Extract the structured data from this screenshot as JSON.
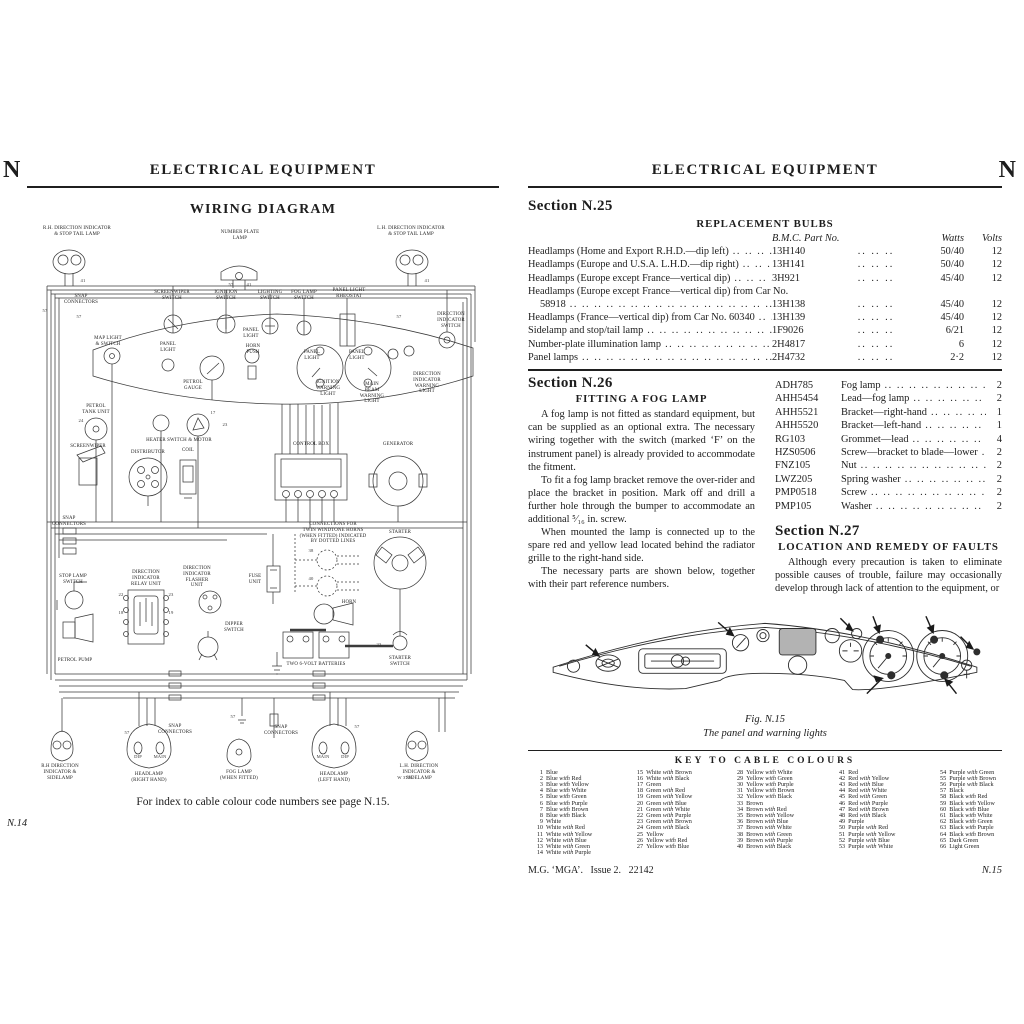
{
  "left_page": {
    "corner_letter": "N",
    "header": "ELECTRICAL EQUIPMENT",
    "title": "WIRING DIAGRAM",
    "footer_note": "For index to cable colour code numbers see page N.15.",
    "page_number": "N.14",
    "diagram_labels": [
      {
        "t": "R.H. DIRECTION INDICATOR\n& STOP TAIL LAMP",
        "x": 50,
        "y": 4,
        "w": 70
      },
      {
        "t": "NUMBER PLATE\nLAMP",
        "x": 213,
        "y": 8
      },
      {
        "t": "L.H. DIRECTION INDICATOR\n& STOP TAIL LAMP",
        "x": 384,
        "y": 4,
        "w": 70
      },
      {
        "t": "SNAP\nCONNECTORS",
        "x": 54,
        "y": 72
      },
      {
        "t": "SCREENWIPER\nSWITCH",
        "x": 145,
        "y": 68
      },
      {
        "t": "IGNITION\nSWITCH",
        "x": 199,
        "y": 68
      },
      {
        "t": "LIGHTING\nSWITCH",
        "x": 243,
        "y": 68
      },
      {
        "t": "FOG LAMP\nSWITCH",
        "x": 277,
        "y": 68
      },
      {
        "t": "PANEL LIGHT\nRHEOSTAT",
        "x": 322,
        "y": 66
      },
      {
        "t": "DIRECTION\nINDICATOR\nSWITCH",
        "x": 424,
        "y": 90
      },
      {
        "t": "MAP LIGHT\n& SWITCH",
        "x": 81,
        "y": 114
      },
      {
        "t": "PANEL\nLIGHT",
        "x": 141,
        "y": 120
      },
      {
        "t": "PANEL\nLIGHT",
        "x": 224,
        "y": 106
      },
      {
        "t": "HORN\nPUSH",
        "x": 226,
        "y": 122
      },
      {
        "t": "PETROL\nGAUGE",
        "x": 166,
        "y": 158
      },
      {
        "t": "PANEL\nLIGHT",
        "x": 285,
        "y": 128
      },
      {
        "t": "PANEL\nLIGHT",
        "x": 330,
        "y": 128
      },
      {
        "t": "IGNITION\nWARNING\nLIGHT",
        "x": 301,
        "y": 158
      },
      {
        "t": "MAIN\nBEAM\nWARNING\nLIGHT",
        "x": 345,
        "y": 160
      },
      {
        "t": "DIRECTION\nINDICATOR\nWARNING\nLIGHT",
        "x": 400,
        "y": 150
      },
      {
        "t": "PETROL\nTANK UNIT",
        "x": 69,
        "y": 182
      },
      {
        "t": "SCREENWIPER",
        "x": 61,
        "y": 222
      },
      {
        "t": "DISTRIBUTOR",
        "x": 121,
        "y": 228
      },
      {
        "t": "COIL",
        "x": 161,
        "y": 226
      },
      {
        "t": "HEATER SWITCH & MOTOR",
        "x": 152,
        "y": 216,
        "w": 90
      },
      {
        "t": "CONTROL BOX",
        "x": 284,
        "y": 220
      },
      {
        "t": "GENERATOR",
        "x": 371,
        "y": 220
      },
      {
        "t": "SNAP\nCONNECTORS",
        "x": 42,
        "y": 294
      },
      {
        "t": "STOP LAMP\nSWITCH",
        "x": 46,
        "y": 352
      },
      {
        "t": "DIRECTION\nINDICATOR\nRELAY UNIT",
        "x": 119,
        "y": 348
      },
      {
        "t": "DIRECTION\nINDICATOR\nFLASHER\nUNIT",
        "x": 170,
        "y": 344
      },
      {
        "t": "DIPPER\nSWITCH",
        "x": 207,
        "y": 400
      },
      {
        "t": "FUSE\nUNIT",
        "x": 228,
        "y": 352
      },
      {
        "t": "CONNECTIONS FOR\nTWIN WINDTONE HORNS\n(WHEN FITTED) INDICATED\nBY DOTTED LINES",
        "x": 306,
        "y": 300,
        "w": 86
      },
      {
        "t": "STARTER",
        "x": 373,
        "y": 308
      },
      {
        "t": "HORN",
        "x": 322,
        "y": 378
      },
      {
        "t": "PETROL PUMP",
        "x": 48,
        "y": 436
      },
      {
        "t": "TWO 6-VOLT BATTERIES",
        "x": 289,
        "y": 440,
        "w": 100
      },
      {
        "t": "STARTER\nSWITCH",
        "x": 373,
        "y": 434
      },
      {
        "t": "SNAP\nCONNECTORS",
        "x": 148,
        "y": 502
      },
      {
        "t": "SNAP\nCONNECTORS",
        "x": 254,
        "y": 503
      },
      {
        "t": "R.H DIRECTION\nINDICATOR &\nSIDELAMP",
        "x": 33,
        "y": 542
      },
      {
        "t": "DIP",
        "x": 111,
        "y": 532,
        "c": "num"
      },
      {
        "t": "MAIN",
        "x": 133,
        "y": 532,
        "c": "num"
      },
      {
        "t": "HEADLAMP\n(RIGHT HAND)",
        "x": 122,
        "y": 550
      },
      {
        "t": "FOG LAMP\n(WHEN FITTED)",
        "x": 212,
        "y": 548
      },
      {
        "t": "MAIN",
        "x": 296,
        "y": 532,
        "c": "num"
      },
      {
        "t": "DIP",
        "x": 318,
        "y": 532,
        "c": "num"
      },
      {
        "t": "HEADLAMP\n(LEFT HAND)",
        "x": 307,
        "y": 550
      },
      {
        "t": "W 3776",
        "x": 378,
        "y": 553,
        "c": "num"
      },
      {
        "t": "L.H. DIRECTION\nINDICATOR &\nSIDELAMP",
        "x": 392,
        "y": 542
      },
      {
        "t": "57",
        "x": 18,
        "y": 86,
        "c": "num"
      },
      {
        "t": "41",
        "x": 56,
        "y": 56,
        "c": "num"
      },
      {
        "t": "57",
        "x": 52,
        "y": 92,
        "c": "num"
      },
      {
        "t": "57",
        "x": 204,
        "y": 60,
        "c": "num"
      },
      {
        "t": "41",
        "x": 222,
        "y": 60,
        "c": "num"
      },
      {
        "t": "57",
        "x": 372,
        "y": 92,
        "c": "num"
      },
      {
        "t": "41",
        "x": 400,
        "y": 56,
        "c": "num"
      },
      {
        "t": "24",
        "x": 54,
        "y": 196,
        "c": "num"
      },
      {
        "t": "17",
        "x": 186,
        "y": 188,
        "c": "num"
      },
      {
        "t": "23",
        "x": 198,
        "y": 200,
        "c": "num"
      },
      {
        "t": "38",
        "x": 284,
        "y": 326,
        "c": "num"
      },
      {
        "t": "40",
        "x": 284,
        "y": 354,
        "c": "num"
      },
      {
        "t": "22",
        "x": 94,
        "y": 370,
        "c": "num"
      },
      {
        "t": "23",
        "x": 144,
        "y": 370,
        "c": "num"
      },
      {
        "t": "18",
        "x": 94,
        "y": 388,
        "c": "num"
      },
      {
        "t": "19",
        "x": 144,
        "y": 388,
        "c": "num"
      },
      {
        "t": "33",
        "x": 352,
        "y": 420,
        "c": "num"
      },
      {
        "t": "57",
        "x": 206,
        "y": 492,
        "c": "num"
      },
      {
        "t": "57",
        "x": 100,
        "y": 508,
        "c": "num"
      },
      {
        "t": "57",
        "x": 330,
        "y": 502,
        "c": "num"
      }
    ]
  },
  "right_page": {
    "corner_letter": "N",
    "header": "ELECTRICAL EQUIPMENT",
    "page_number": "N.15",
    "footer_book": "M.G. ‘MGA’.",
    "footer_issue": "Issue 2.",
    "footer_code": "22142",
    "leader_fill": ".. .. .. .. .. .. .. .. .. .. .. .. .. .. .. .. .. .. .. ..",
    "leader_mid": ".. .. ..",
    "n25": {
      "heading": "Section N.25",
      "subheading": "REPLACEMENT BULBS",
      "col_part": "B.M.C. Part No.",
      "col_watts": "Watts",
      "col_volts": "Volts",
      "rows": [
        {
          "desc": "Headlamps (Home and Export R.H.D.—dip left)",
          "part": "13H140",
          "watts": "50/40",
          "volts": "12"
        },
        {
          "desc": "Headlamps (Europe and U.S.A. L.H.D.—dip right)",
          "part": "13H141",
          "watts": "50/40",
          "volts": "12"
        },
        {
          "desc": "Headlamps (Europe except France—vertical dip)",
          "part": "3H921",
          "watts": "45/40",
          "volts": "12"
        },
        {
          "desc": "Headlamps (Europe except France—vertical dip) from Car No.",
          "desc2": "58918",
          "part": "13H138",
          "watts": "45/40",
          "volts": "12"
        },
        {
          "desc": "Headlamps (France—vertical dip) from Car No. 60340",
          "part": "13H139",
          "watts": "45/40",
          "volts": "12"
        },
        {
          "desc": "Sidelamp and stop/tail lamp",
          "part": "1F9026",
          "watts": "6/21",
          "volts": "12"
        },
        {
          "desc": "Number-plate illumination lamp",
          "part": "2H4817",
          "watts": "6",
          "volts": "12"
        },
        {
          "desc": "Panel lamps",
          "part": "2H4732",
          "watts": "2·2",
          "volts": "12"
        }
      ]
    },
    "n26": {
      "heading": "Section N.26",
      "subheading": "FITTING A FOG LAMP",
      "paragraphs": [
        "A fog lamp is not fitted as standard equipment, but can be supplied as an optional extra.  The necessary wiring together with the switch (marked ‘F’ on the instrument panel) is already provided to accommodate the fitment.",
        "To fit a fog lamp bracket remove the over-rider and place the bracket in position.  Mark off and drill a further hole through the bumper to accommodate an additional ⁵⁄₁₆ in. screw.",
        "When mounted the lamp is connected up to the spare red and yellow lead located behind the radiator grille to the right-hand side.",
        "The necessary parts are shown below, together with their part reference numbers."
      ],
      "parts": [
        {
          "part": "ADH785",
          "name": "Fog lamp",
          "qty": "2"
        },
        {
          "part": "AHH5454",
          "name": "Lead—fog lamp",
          "qty": "2"
        },
        {
          "part": "AHH5521",
          "name": "Bracket—right-hand",
          "qty": "1"
        },
        {
          "part": "AHH5520",
          "name": "Bracket—left-hand",
          "qty": "1"
        },
        {
          "part": "RG103",
          "name": "Grommet—lead",
          "qty": "4"
        },
        {
          "part": "HZS0506",
          "name": "Screw—bracket to blade—lower",
          "qty": "2"
        },
        {
          "part": "FNZ105",
          "name": "Nut",
          "qty": "2"
        },
        {
          "part": "LWZ205",
          "name": "Spring washer",
          "qty": "2"
        },
        {
          "part": "PMP0518",
          "name": "Screw",
          "qty": "2"
        },
        {
          "part": "PMP105",
          "name": "Washer",
          "qty": "2"
        }
      ]
    },
    "n27": {
      "heading": "Section N.27",
      "subheading": "LOCATION AND REMEDY OF FAULTS",
      "paragraph": "Although every precaution is taken to eliminate possible causes of trouble, failure may occasionally develop through lack of attention to the equipment, or"
    },
    "figure": {
      "title": "Fig. N.15",
      "subtitle": "The panel and warning lights"
    },
    "key": {
      "heading": "KEY TO CABLE COLOURS",
      "colours": [
        "Blue",
        "Blue with Red",
        "Blue with Yellow",
        "Blue with White",
        "Blue with Green",
        "Blue with Purple",
        "Blue with Brown",
        "Blue with Black",
        "White",
        "White with Red",
        "White with Yellow",
        "White with Blue",
        "White with Green",
        "White with Purple",
        "White with Brown",
        "White with Black",
        "Green",
        "Green with Red",
        "Green with Yellow",
        "Green with Blue",
        "Green with White",
        "Green with Purple",
        "Green with Brown",
        "Green with Black",
        "Yellow",
        "Yellow with Red",
        "Yellow with Blue",
        "Yellow with White",
        "Yellow with Green",
        "Yellow with Purple",
        "Yellow with Brown",
        "Yellow with Black",
        "Brown",
        "Brown with Red",
        "Brown with Yellow",
        "Brown with Blue",
        "Brown with White",
        "Brown with Green",
        "Brown with Purple",
        "Brown with Black",
        "Red",
        "Red with Yellow",
        "Red with Blue",
        "Red with White",
        "Red with Green",
        "Red with Purple",
        "Red with Brown",
        "Red with Black",
        "Purple",
        "Purple with Red",
        "Purple with Yellow",
        "Purple with Blue",
        "Purple with White",
        "Purple with Green",
        "Purple with Brown",
        "Purple with Black",
        "Black",
        "Black with Red",
        "Black with Yellow",
        "Black with Blue",
        "Black with White",
        "Black with Green",
        "Black with Purple",
        "Black with Brown",
        "Dark Green",
        "Light Green"
      ]
    }
  }
}
